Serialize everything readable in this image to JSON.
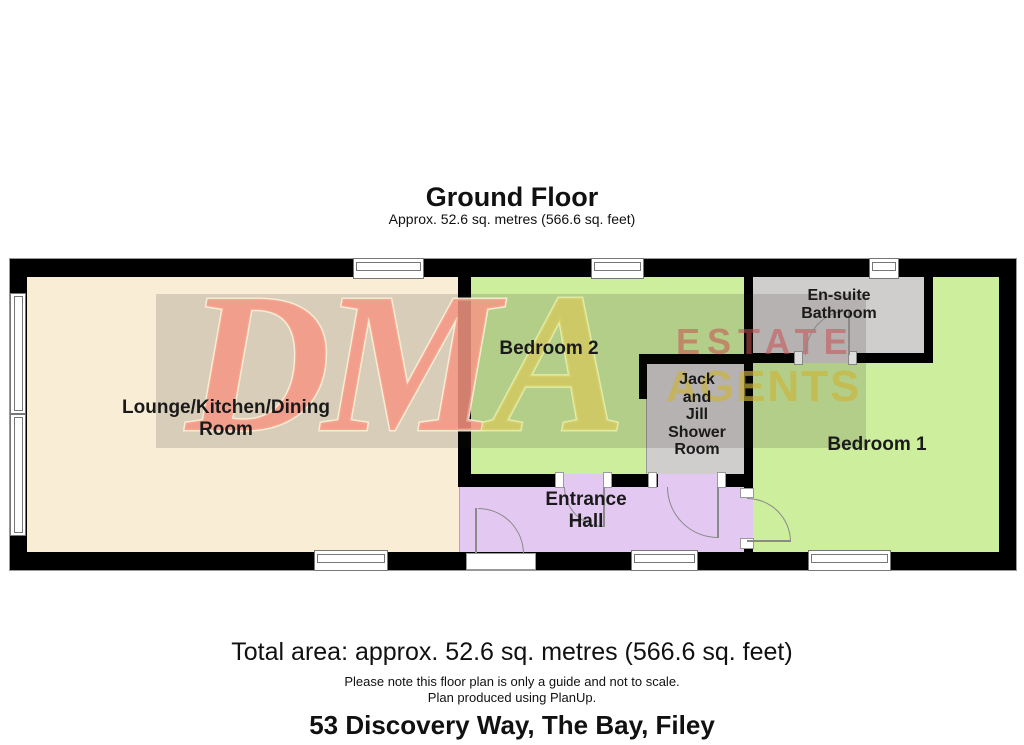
{
  "header": {
    "title": "Ground Floor",
    "subtitle": "Approx. 52.6 sq. metres (566.6 sq. feet)"
  },
  "rooms": {
    "lounge": {
      "label": "Lounge/Kitchen/Dining\nRoom"
    },
    "bedroom2": {
      "label": "Bedroom 2"
    },
    "ensuite": {
      "label": "En-suite\nBathroom"
    },
    "shower": {
      "label": "Jack\nand\nJill\nShower\nRoom"
    },
    "bedroom1": {
      "label": "Bedroom 1"
    },
    "hall": {
      "label": "Entrance\nHall"
    }
  },
  "watermark": {
    "brand_dm": "DM",
    "brand_a": "A",
    "tagline_line1": "ESTATE",
    "tagline_line2": "AGENTS"
  },
  "footer": {
    "total_area": "Total area: approx. 52.6 sq. metres (566.6 sq. feet)",
    "disclaimer": "Please note this floor plan is only a guide and not to scale.",
    "credit": "Plan produced using PlanUp.",
    "address": "53 Discovery Way, The Bay, Filey"
  },
  "colors": {
    "floor-lounge": "#FAEDD5",
    "floor-bedroom": "#CDEE9D",
    "floor-bathroom": "#D0CDCD",
    "floor-hall": "#E3C9F2",
    "wall": "#000000",
    "watermark-pink": "#F0958A",
    "watermark-yellow": "#D2C25E"
  }
}
